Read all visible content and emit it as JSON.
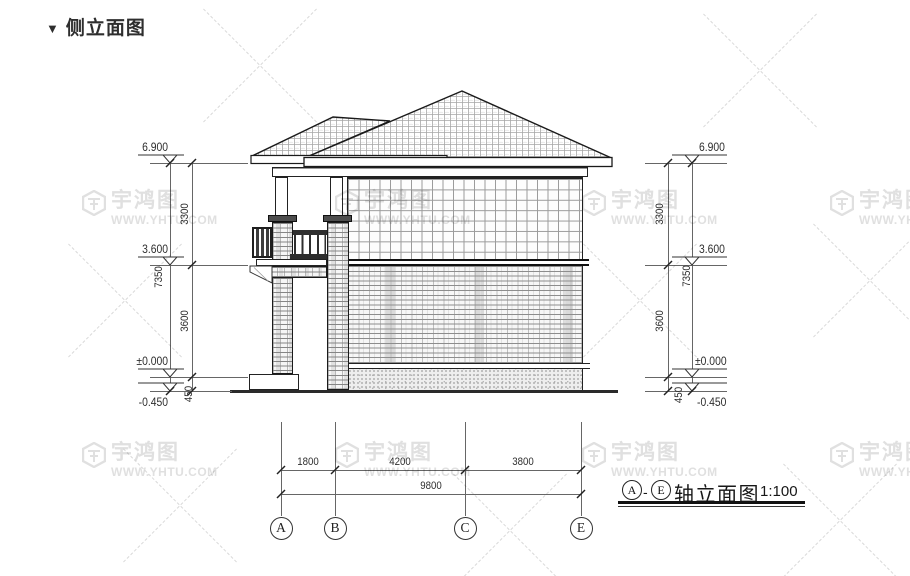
{
  "title": {
    "marker": "▼",
    "text": "侧立面图"
  },
  "levels": [
    "6.900",
    "3.600",
    "±0.000",
    "-0.450"
  ],
  "vdims": {
    "upper": "3300",
    "lower": "3600",
    "base": "450",
    "overall": "7350"
  },
  "hdims": {
    "ab": "1800",
    "bc": "4200",
    "ce": "3800",
    "total": "9800"
  },
  "axes": [
    "A",
    "B",
    "C",
    "E"
  ],
  "caption": {
    "from": "A",
    "sep": "-",
    "to": "E",
    "label": "轴立面图",
    "scale": "1:100"
  },
  "watermark": {
    "brand": "宇鸿图",
    "url": "WWW.YHTU.COM"
  },
  "colors": {
    "line": "#222222",
    "dim": "#666666",
    "watermark": "#e0e0e0"
  }
}
